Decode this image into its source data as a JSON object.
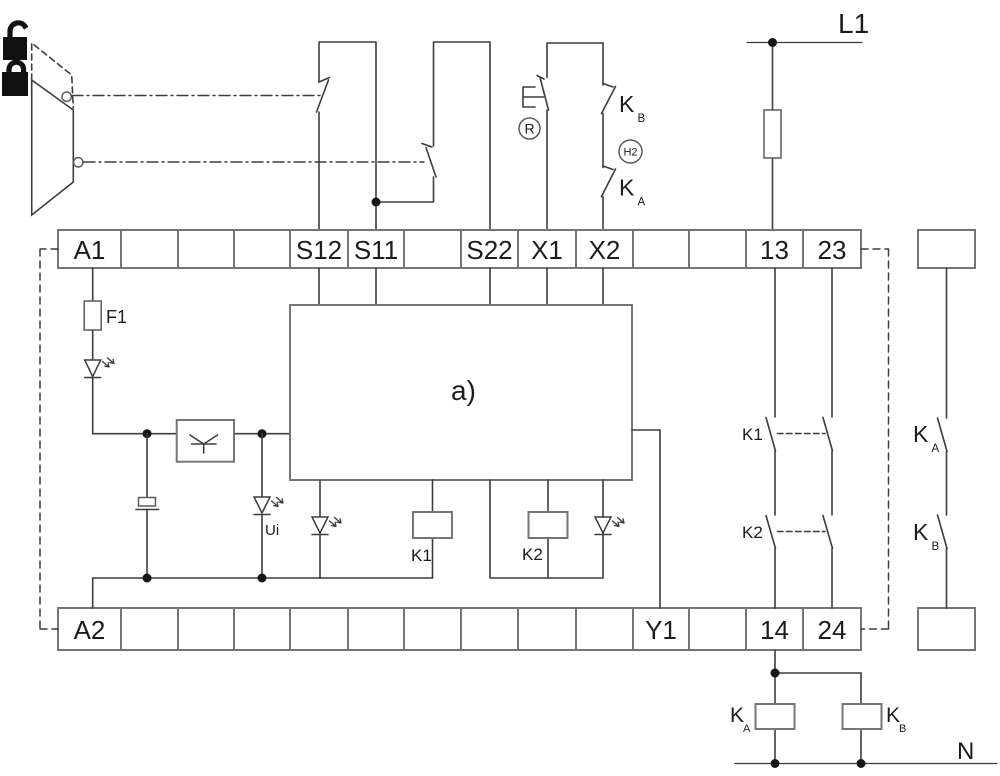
{
  "terminals": {
    "top": [
      "A1",
      "",
      "",
      "",
      "S12",
      "S11",
      "",
      "S22",
      "X1",
      "X2",
      "",
      "",
      "13",
      "23"
    ],
    "bottom": [
      "A2",
      "",
      "",
      "",
      "",
      "",
      "",
      "",
      "",
      "",
      "Y1",
      "",
      "14",
      "24"
    ]
  },
  "power_labels": {
    "l1": "L1",
    "n": "N"
  },
  "component_labels": {
    "fuse": "F1",
    "module": "a)",
    "internal_voltage": "Ui",
    "coil_k1": "K1",
    "coil_k2": "K2",
    "contact_k1": "K1",
    "contact_k2": "K2",
    "lamp": "H2",
    "reset": "R",
    "contactor_letter": "K",
    "subscript_a": "A",
    "subscript_b": "B"
  },
  "icons": [
    "unlocked-padlock-icon",
    "locked-padlock-icon"
  ],
  "colors": {
    "wire": "#3d3d3d",
    "terminal_border": "#757575",
    "text": "#1c1c1c",
    "junction": "#161616",
    "background": "#ffffff"
  }
}
